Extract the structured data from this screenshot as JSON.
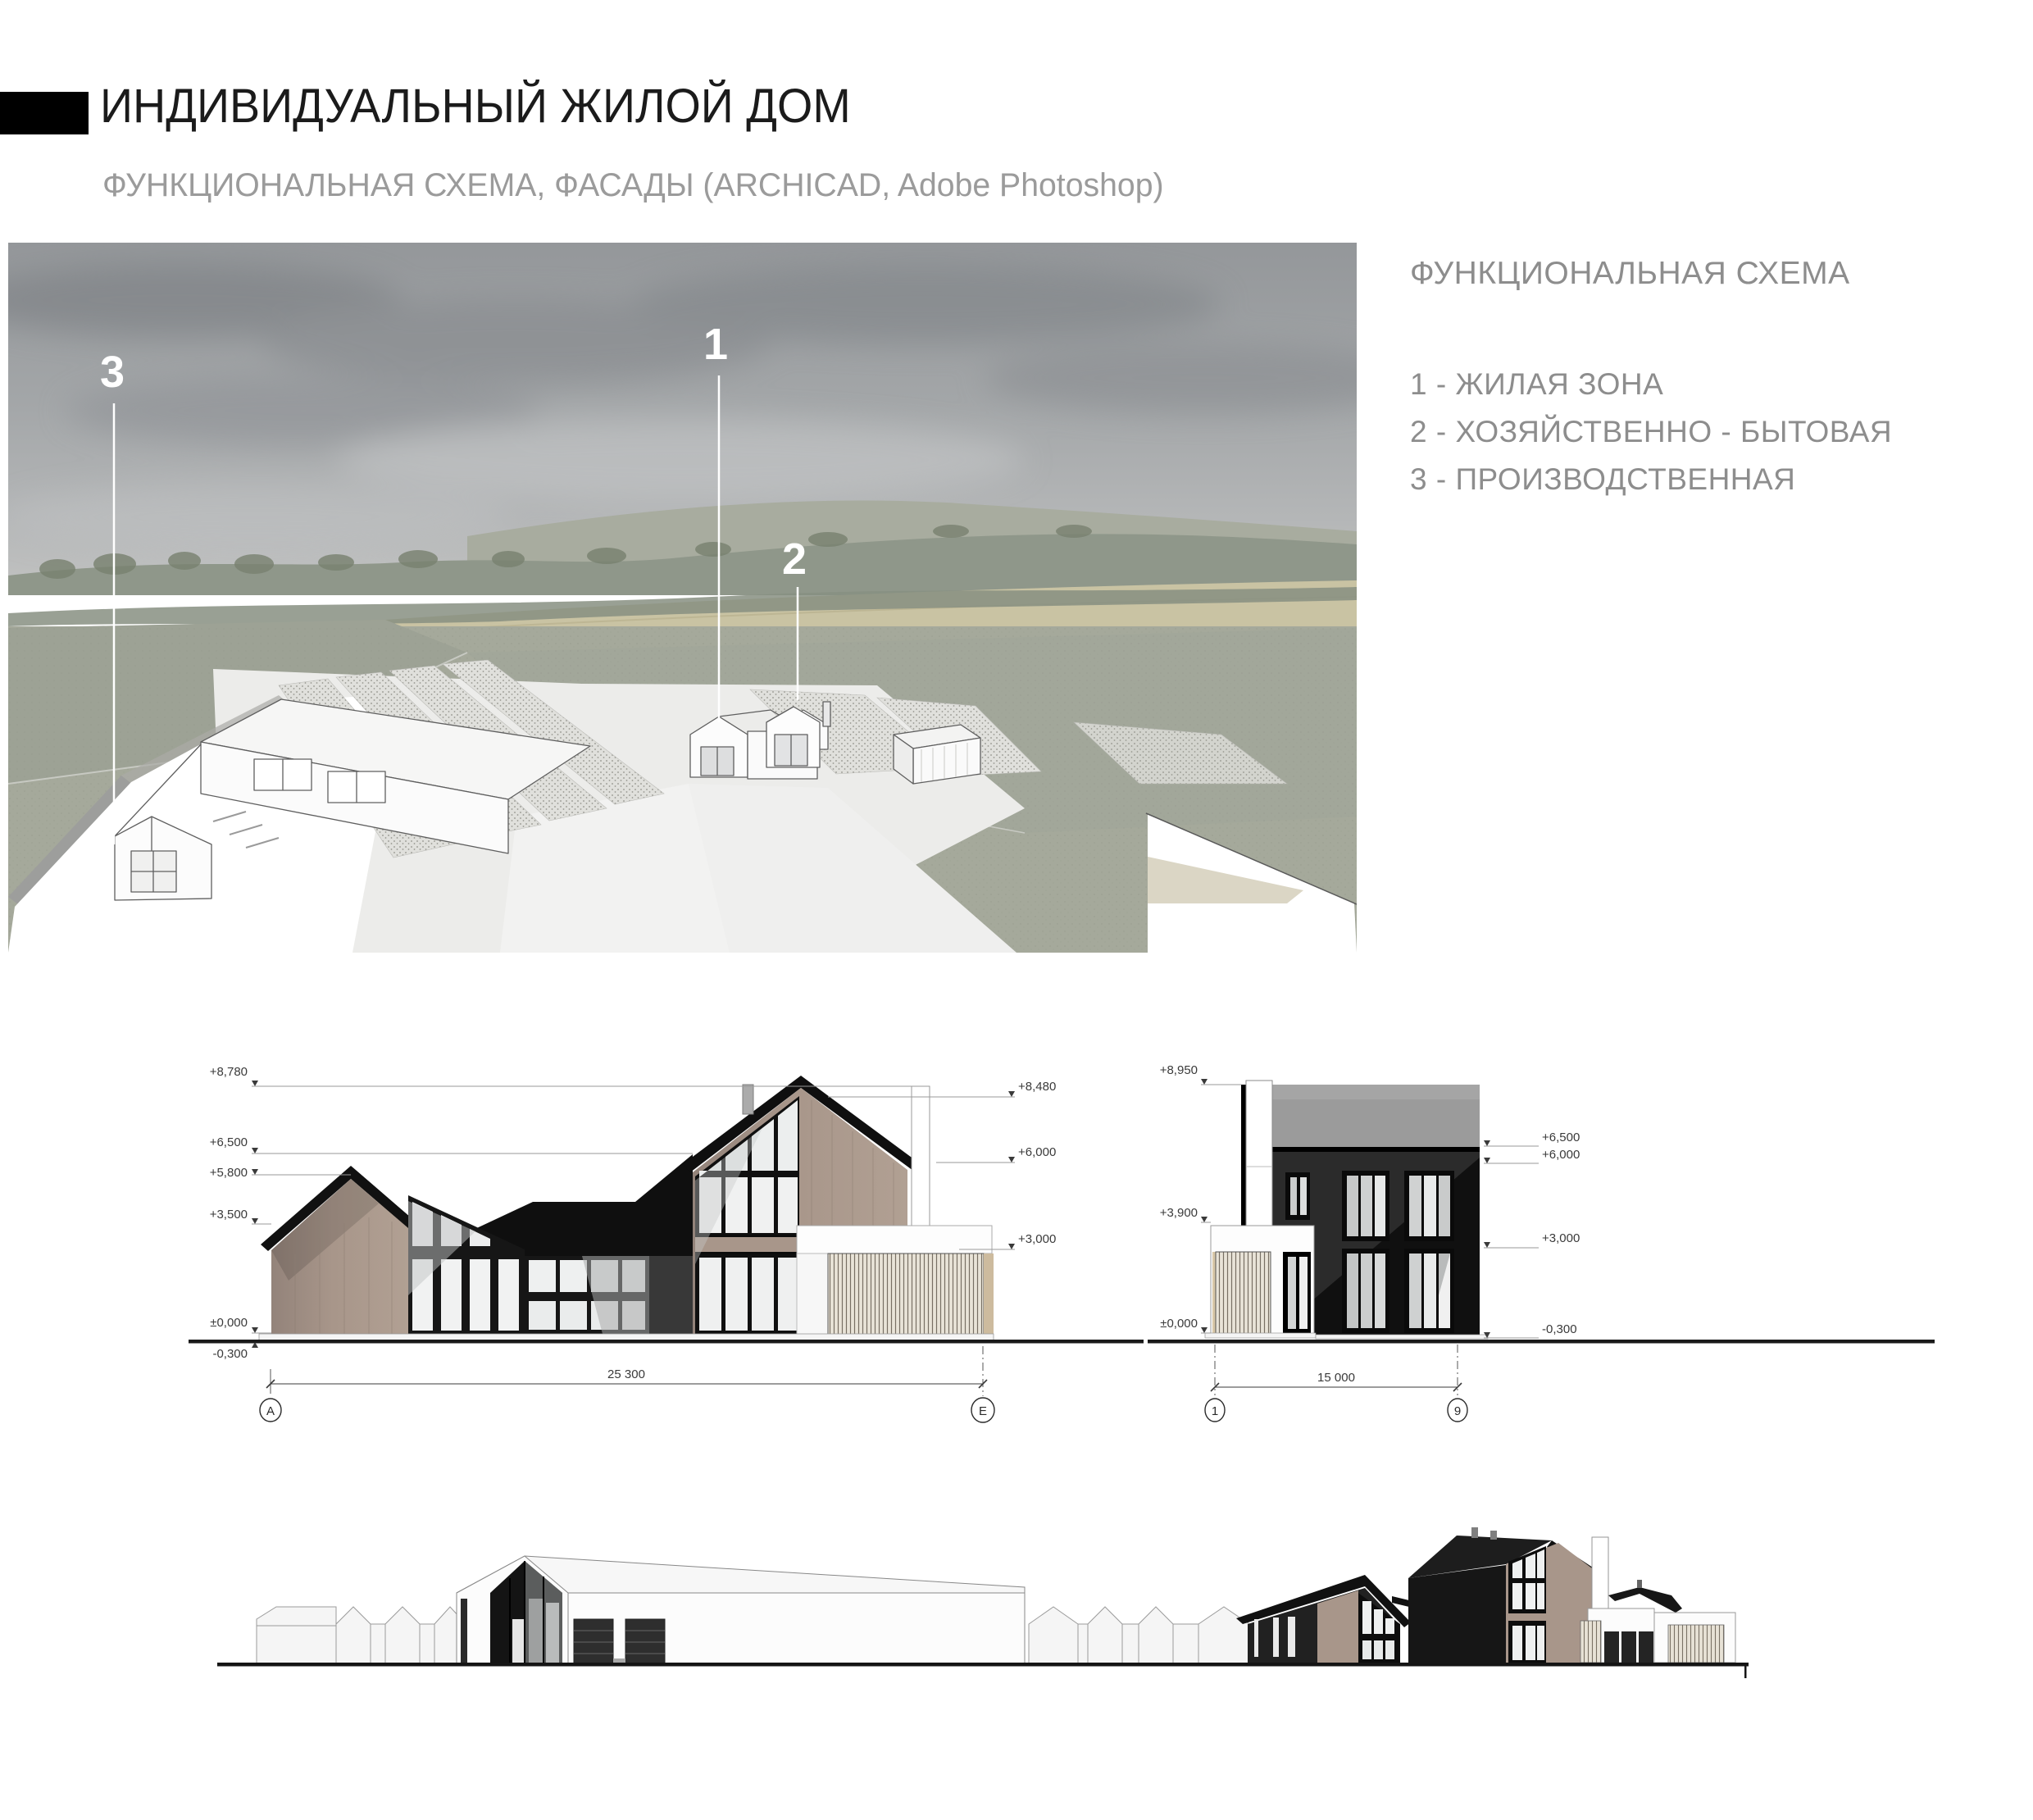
{
  "header": {
    "title": "ИНДИВИДУАЛЬНЫЙ ЖИЛОЙ ДОМ",
    "subtitle": "ФУНКЦИОНАЛЬНАЯ СХЕМА, ФАСАДЫ  (ARCHICAD, Adobe Photoshop)"
  },
  "legend": {
    "title": "ФУНКЦИОНАЛЬНАЯ СХЕМА",
    "items": [
      "1 - ЖИЛАЯ ЗОНА",
      "2 - ХОЗЯЙСТВЕННО - БЫТОВАЯ",
      "3 - ПРОИЗВОДСТВЕННАЯ"
    ]
  },
  "render": {
    "zone_labels": [
      "1",
      "2",
      "3"
    ]
  },
  "facade_a": {
    "levels_left": [
      "+8,780",
      "+6,500",
      "+5,800",
      "+3,500",
      "±0,000",
      "-0,300"
    ],
    "levels_right": [
      "+8,480",
      "+6,000",
      "+3,000"
    ],
    "dimension": "25 300",
    "axis_left": "А",
    "axis_right": "Е"
  },
  "facade_b": {
    "levels_left": [
      "+8,950",
      "+3,900",
      "±0,000"
    ],
    "levels_right": [
      "+6,500",
      "+6,000",
      "+3,000",
      "-0,300"
    ],
    "dimension": "15 000",
    "axis_left": "1",
    "axis_right": "9"
  },
  "colors": {
    "accent_black": "#141414",
    "wood": "#a8968a",
    "roof_gray": "#9b9b9b",
    "landscape_green": "#a5a99b",
    "text_gray": "#8d8d8d"
  }
}
